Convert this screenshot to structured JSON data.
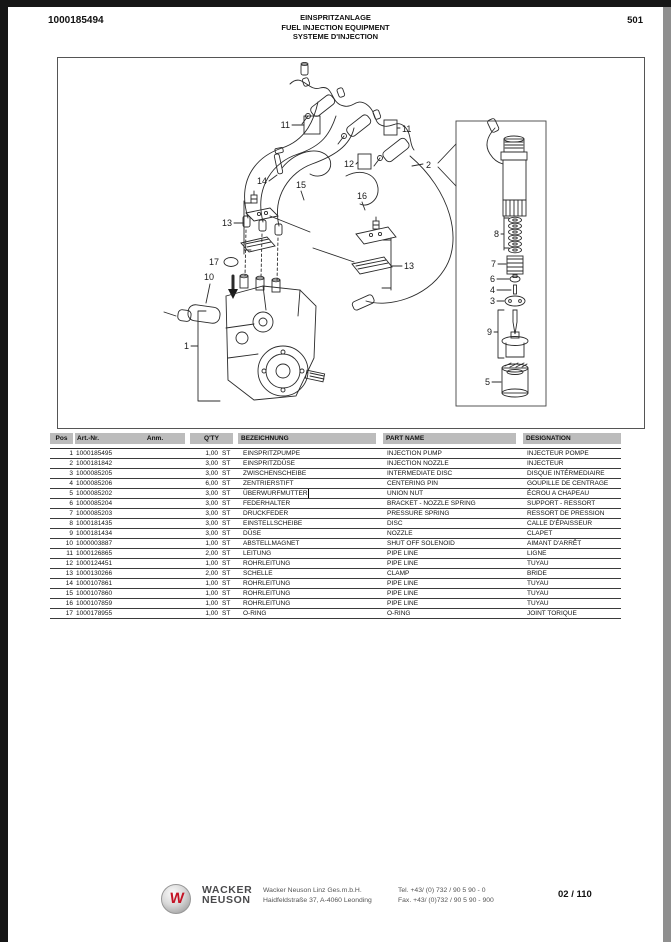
{
  "header": {
    "doc_number": "1000185494",
    "title_de": "EINSPRITZANLAGE",
    "title_en": "FUEL INJECTION EQUIPMENT",
    "title_fr": "SYSTEME D'INJECTION",
    "page_number": "501"
  },
  "diagram": {
    "callouts": {
      "c11l": "11",
      "c11r": "11",
      "c12": "12",
      "c2": "2",
      "c14": "14",
      "c15": "15",
      "c16": "16",
      "c13l": "13",
      "c13r": "13",
      "c17": "17",
      "c10": "10",
      "c1": "1",
      "c8": "8",
      "c7": "7",
      "c6": "6",
      "c4": "4",
      "c3": "3",
      "c9": "9",
      "c5": "5"
    }
  },
  "table": {
    "columns": {
      "pos": "Pos",
      "art": "Art.-Nr.",
      "anm": "Anm.",
      "qty": "Q'TY",
      "bez": "BEZEICHNUNG",
      "part": "PART NAME",
      "desg": "DESIGNATION"
    },
    "text_cursor_row_pos": "5",
    "rows": [
      {
        "pos": "1",
        "art": "1000185495",
        "anm": "",
        "qty": "1,00",
        "unit": "ST",
        "de": "EINSPRITZPUMPE",
        "en": "INJECTION PUMP",
        "fr": "INJECTEUR POMPE"
      },
      {
        "pos": "2",
        "art": "1000181842",
        "anm": "",
        "qty": "3,00",
        "unit": "ST",
        "de": "EINSPRITZDÜSE",
        "en": "INJECTION NOZZLE",
        "fr": "INJECTEUR"
      },
      {
        "pos": "3",
        "art": "1000085205",
        "anm": "",
        "qty": "3,00",
        "unit": "ST",
        "de": "ZWISCHENSCHEIBE",
        "en": "INTERMEDIATE DISC",
        "fr": "DISQUE INTÉRMEDIAIRE"
      },
      {
        "pos": "4",
        "art": "1000085206",
        "anm": "",
        "qty": "6,00",
        "unit": "ST",
        "de": "ZENTRIERSTIFT",
        "en": "CENTERING PIN",
        "fr": "GOUPILLE DE CENTRAGE"
      },
      {
        "pos": "5",
        "art": "1000085202",
        "anm": "",
        "qty": "3,00",
        "unit": "ST",
        "de": "ÜBERWURFMUTTER",
        "en": "UNION NUT",
        "fr": "ÉCROU A CHAPEAU"
      },
      {
        "pos": "6",
        "art": "1000085204",
        "anm": "",
        "qty": "3,00",
        "unit": "ST",
        "de": "FEDERHALTER",
        "en": "BRACKET - NOZZLE SPRING",
        "fr": "SUPPORT - RESSORT"
      },
      {
        "pos": "7",
        "art": "1000085203",
        "anm": "",
        "qty": "3,00",
        "unit": "ST",
        "de": "DRUCKFEDER",
        "en": "PRESSURE SPRING",
        "fr": "RESSORT DE PRESSION"
      },
      {
        "pos": "8",
        "art": "1000181435",
        "anm": "",
        "qty": "3,00",
        "unit": "ST",
        "de": "EINSTELLSCHEIBE",
        "en": "DISC",
        "fr": "CALLE D'ÉPAISSEUR"
      },
      {
        "pos": "9",
        "art": "1000181434",
        "anm": "",
        "qty": "3,00",
        "unit": "ST",
        "de": "DÜSE",
        "en": "NOZZLE",
        "fr": "CLAPET"
      },
      {
        "pos": "10",
        "art": "1000003887",
        "anm": "",
        "qty": "1,00",
        "unit": "ST",
        "de": "ABSTELLMAGNET",
        "en": "SHUT OFF SOLENOID",
        "fr": "AIMANT D'ARRÊT"
      },
      {
        "pos": "11",
        "art": "1000126865",
        "anm": "",
        "qty": "2,00",
        "unit": "ST",
        "de": "LEITUNG",
        "en": "PIPE LINE",
        "fr": "LIGNE"
      },
      {
        "pos": "12",
        "art": "1000124451",
        "anm": "",
        "qty": "1,00",
        "unit": "ST",
        "de": "ROHRLEITUNG",
        "en": "PIPE LINE",
        "fr": "TUYAU"
      },
      {
        "pos": "13",
        "art": "1000130266",
        "anm": "",
        "qty": "2,00",
        "unit": "ST",
        "de": "SCHELLE",
        "en": "CLAMP",
        "fr": "BRIDE"
      },
      {
        "pos": "14",
        "art": "1000107861",
        "anm": "",
        "qty": "1,00",
        "unit": "ST",
        "de": "ROHRLEITUNG",
        "en": "PIPE LINE",
        "fr": "TUYAU"
      },
      {
        "pos": "15",
        "art": "1000107860",
        "anm": "",
        "qty": "1,00",
        "unit": "ST",
        "de": "ROHRLEITUNG",
        "en": "PIPE LINE",
        "fr": "TUYAU"
      },
      {
        "pos": "16",
        "art": "1000107859",
        "anm": "",
        "qty": "1,00",
        "unit": "ST",
        "de": "ROHRLEITUNG",
        "en": "PIPE LINE",
        "fr": "TUYAU"
      },
      {
        "pos": "17",
        "art": "1000178955",
        "anm": "",
        "qty": "1,00",
        "unit": "ST",
        "de": "O-RING",
        "en": "O-RING",
        "fr": "JOINT TORIQUE"
      }
    ]
  },
  "footer": {
    "logo_letter": "W",
    "brand_line1": "WACKER",
    "brand_line2": "NEUSON",
    "company_line1": "Wacker Neuson Linz Ges.m.b.H.",
    "company_line2": "Haidfeldstraße 37, A-4060 Leonding",
    "tel": "Tel. +43/ (0) 732 / 90 5 90 - 0",
    "fax": "Fax. +43/ (0)732 / 90 5 90 - 900",
    "page_indicator": "02 / 110"
  },
  "colors": {
    "table_header_gray": "#bcbcbc",
    "logo_red": "#c41425",
    "line_art": "#2b2b2b",
    "edge_black": "#161616",
    "edge_gray": "#8f8f8f"
  }
}
